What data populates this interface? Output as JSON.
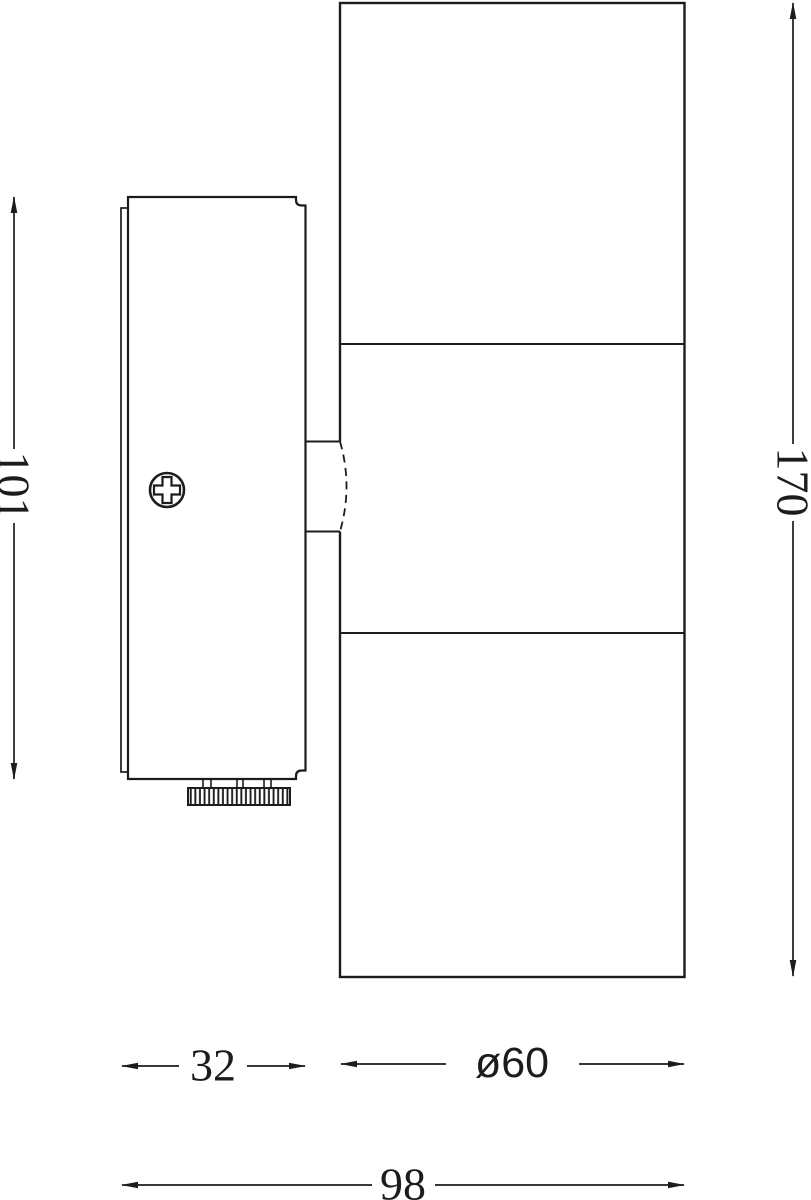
{
  "drawing": {
    "dimensions": {
      "plate_height": "101",
      "overall_height": "170",
      "plate_depth": "32",
      "body_diameter": "ø60",
      "overall_depth": "98"
    },
    "colors": {
      "line": "#1c1c1c",
      "background": "#ffffff"
    }
  }
}
